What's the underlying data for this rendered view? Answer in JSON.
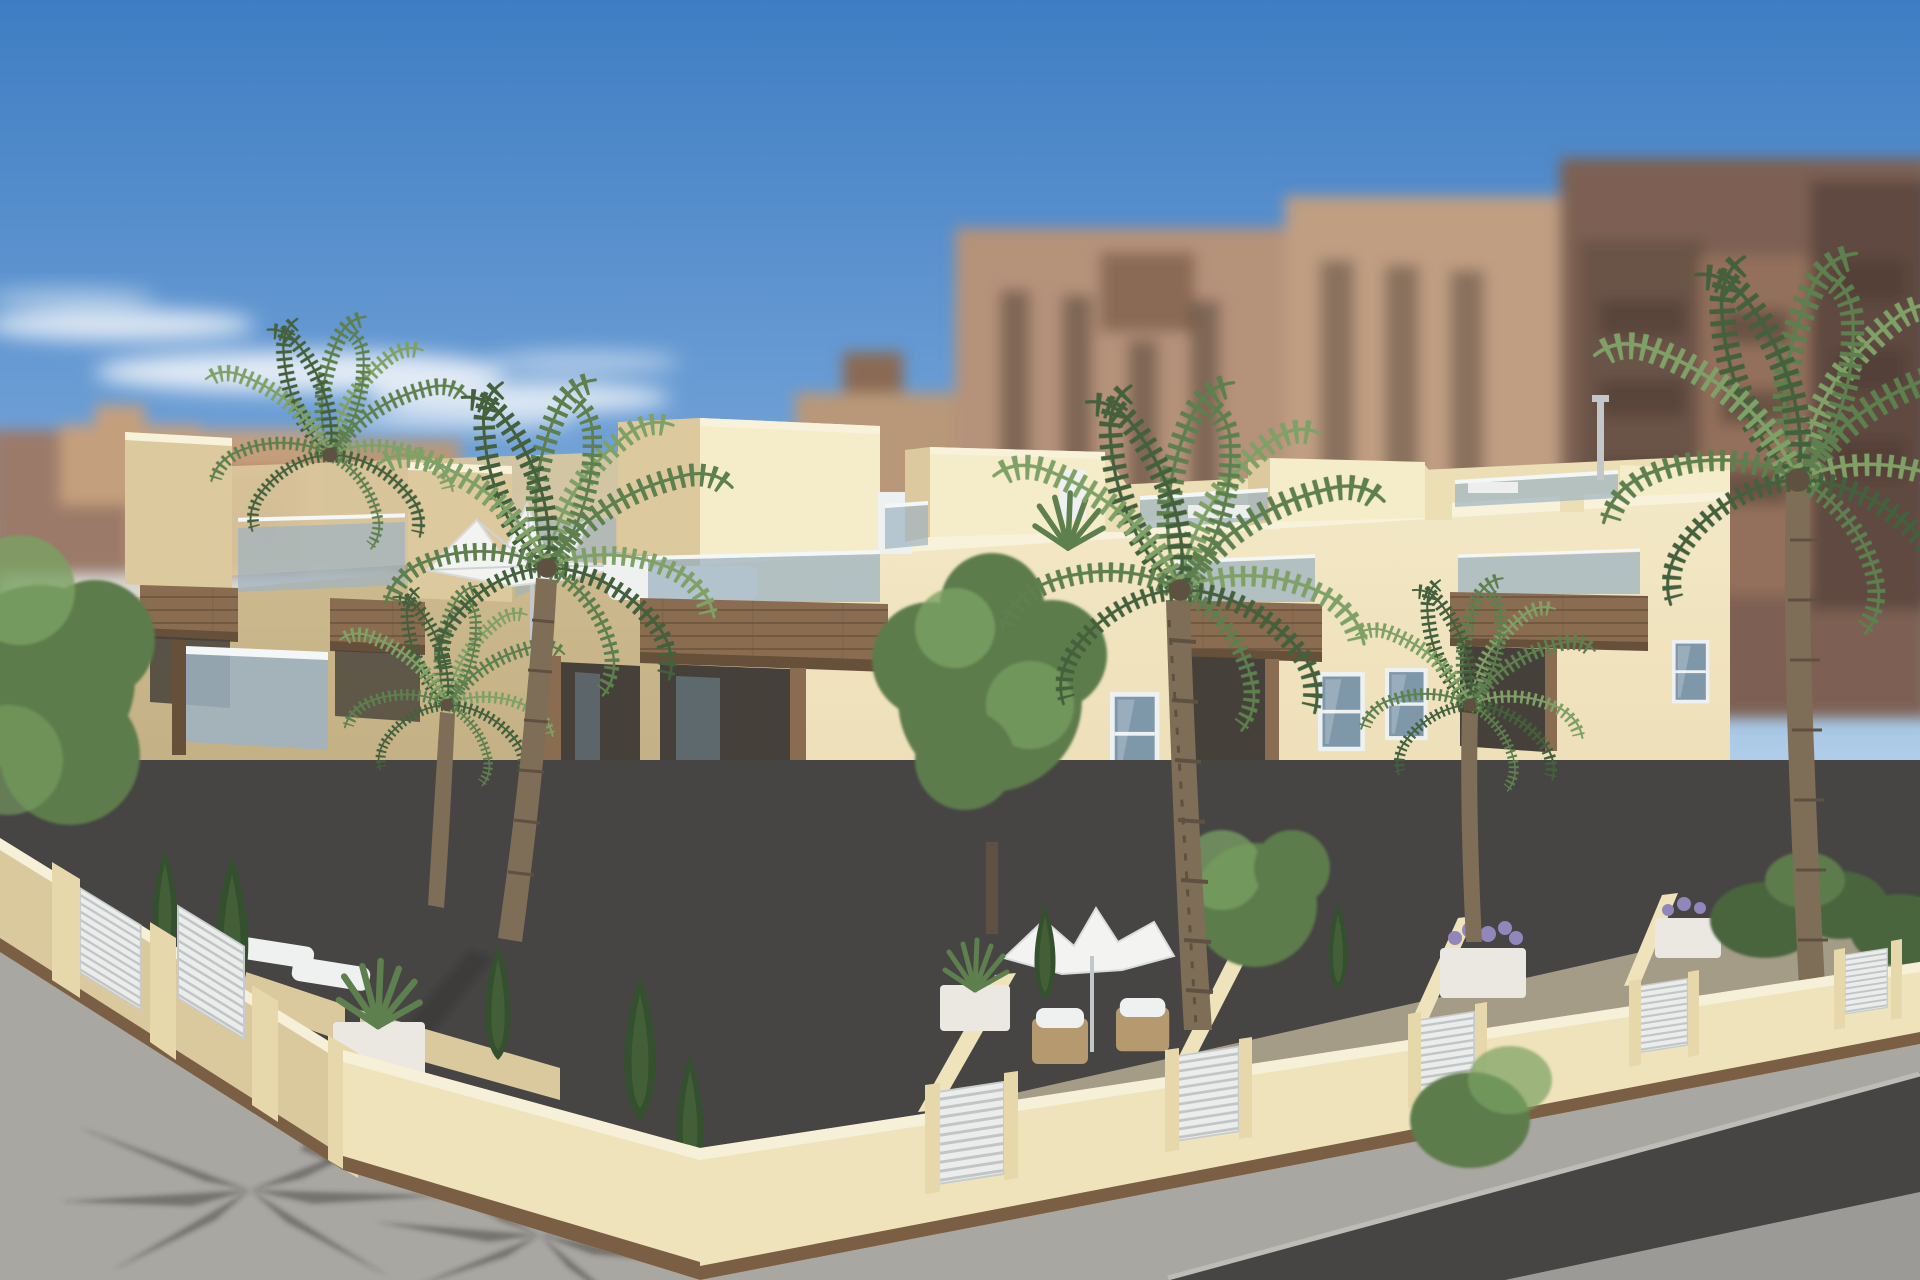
{
  "scene": {
    "kind": "architectural-render",
    "subject": "two-storey cream townhouse complex with roof terraces, wood balcony boxes, glass railings, palm trees, perimeter fence and corner street",
    "elements": [
      "sky",
      "clouds",
      "blurred-city-background",
      "white-background-building",
      "townhouse-left-facade",
      "townhouse-front-facade",
      "roof-terraces",
      "roof-parasol",
      "balcony-wood-boxes",
      "glass-balustrades",
      "windows",
      "entrance-portals",
      "roller-shutter-window",
      "courtyard-gardens",
      "patio-parasol",
      "wicker-chairs",
      "white-loungers",
      "planters",
      "cypress-shrubs",
      "palm-trees",
      "deciduous-trees",
      "perimeter-fence",
      "louver-gate-panels",
      "sidewalk",
      "asphalt-road",
      "parking-lines",
      "palm-shadows"
    ]
  },
  "palette": {
    "sky_top": "#3e7dc3",
    "sky_mid": "#6fa0d6",
    "sky_horizon": "#b8d2ea",
    "cloud": "#eef3f8",
    "bgA": "#9b7a69",
    "bgB": "#a4705a",
    "bgC": "#c49f7d",
    "bgD": "#b89878",
    "bgE": "#b5927a",
    "bgF": "#8a6a55",
    "bgG": "#bf9e82",
    "bgH": "#7d6152",
    "bgI": "#6b5246",
    "bgJ": "#93705c",
    "bgK": "#5f4a40",
    "bg_win": "#4a3b32",
    "bg_white": "#d9d8d2",
    "wall_sun": "#f3e8c6",
    "wall_sun_deep": "#e5d3a5",
    "wall_shade": "#cdbb8f",
    "wall_shade_deep": "#b2a073",
    "parapet": "#f8f2da",
    "terrace_back": "#ecdfb6",
    "tower_sun": "#f5ecca",
    "tower_shade": "#dcc99e",
    "recess_dark": "#45413a",
    "recess_glass": "#6c7f8a",
    "wood": "#8a6d50",
    "wood_dark": "#66503a",
    "wood_light": "#a28058",
    "glass": "#9eb3c2",
    "glass_hi": "#cfdde4",
    "frame": "#f4f7f8",
    "win_frame": "#edf1f2",
    "win_glass": "#7e97a9",
    "win_glass_dark": "#5d7485",
    "shutter": "#e9ebe9",
    "shutter_line": "#c9cdc9",
    "door_dark": "#3e3831",
    "door_leaf": "#5a4c3e",
    "fence_sun": "#efe3bc",
    "fence_shade": "#dbc99e",
    "fence_deep": "#c9b488",
    "coping": "#f7f0d8",
    "base_trim": "#7a5f45",
    "pillar": "#e7d8ab",
    "louver": "#ebedec",
    "louver_line": "#b7bbbb",
    "asphalt": "#464544",
    "sidewalk": "#a9a7a2",
    "sidewalk_hi": "#bebcb6",
    "road_corner": "#9c9a96",
    "stripe": "#d8d7d3",
    "shadow": "#32322f",
    "trunk": "#7e6d57",
    "trunk_dark": "#5e5141",
    "palm_dark": "#44603c",
    "palm_mid": "#5e7f4e",
    "palm_light": "#7fa066",
    "tree": "#5d7c4b",
    "tree_hi": "#7aa163",
    "cypress": "#35502e",
    "shrub": "#48653d",
    "court_shade": "#837e6e",
    "court_sun": "#a49c87",
    "sofa": "#eff1f0",
    "wicker": "#b49a6e",
    "canvas": "#f3f4f2",
    "canvas_shade": "#d9dcdc",
    "planter": "#eae8e1",
    "lavender": "#9187bb",
    "metal": "#c3c7c9"
  }
}
